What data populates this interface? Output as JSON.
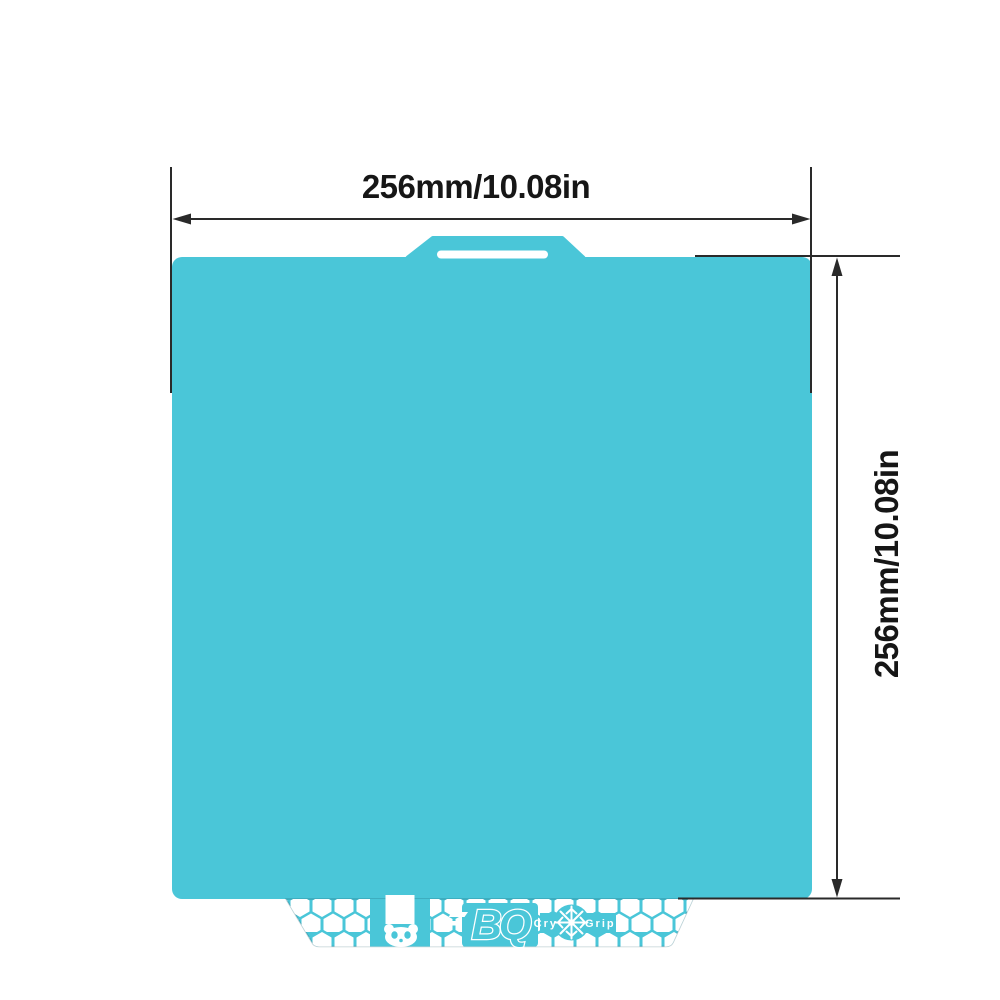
{
  "diagram": {
    "type": "product-dimension-diagram",
    "subject": "textured flexible build plate with honeycomb skirt"
  },
  "dimensions": {
    "top": {
      "label": "256mm/10.08in",
      "orientation": "horizontal"
    },
    "right": {
      "label": "256mm/10.08in",
      "orientation": "vertical"
    }
  },
  "branding": {
    "bq_logo": "BQ",
    "cryo_left": "Cry",
    "cryo_right": "Grip",
    "snowflake_char": "❄"
  },
  "icons": {
    "panda": "panda-icon",
    "snowflake": "snowflake-icon",
    "square": "square-mark-icon"
  },
  "colors": {
    "plate": "#4AC6D8",
    "dimension_line": "#2A2A2A",
    "label_text": "#161616",
    "cutout": "#FFFFFF",
    "background": "#FFFFFF"
  }
}
